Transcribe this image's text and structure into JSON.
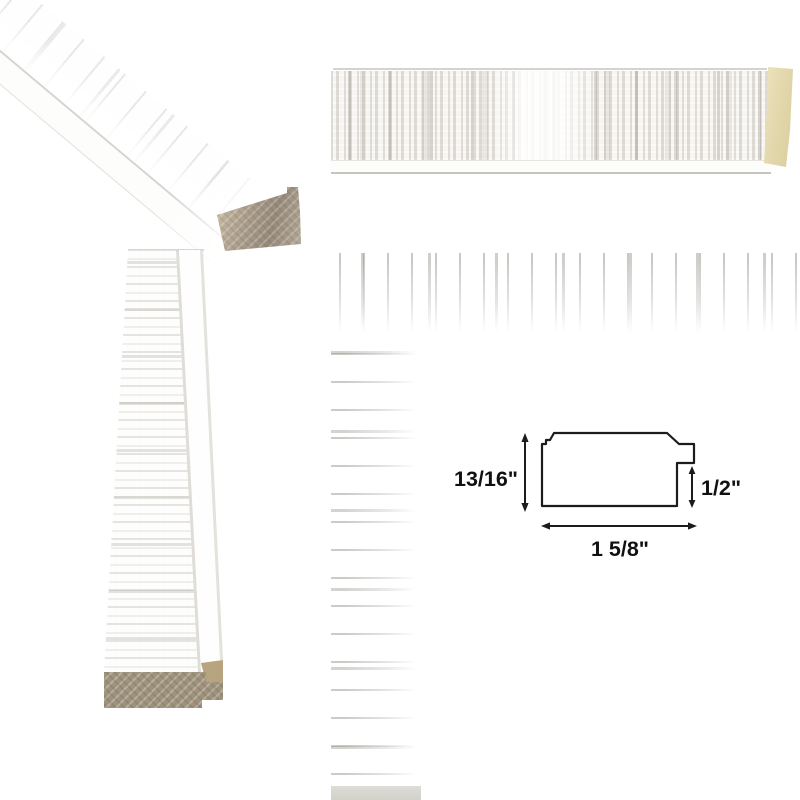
{
  "page": {
    "background_color": "#ffffff"
  },
  "diagram": {
    "height_label": "13/16\"",
    "rabbet_label": "1/2\"",
    "width_label": "1 5/8\"",
    "line_color": "#1c1c1c",
    "text_color": "#111111"
  },
  "materials": {
    "raw_wood_cream": "#e7ddb2",
    "raw_wood_taupe": "#a99c89",
    "raw_wood_tan": "#c8b795",
    "whitewash_streak": "#b7b0a6",
    "edge_shadow": "#c8c5bf"
  }
}
